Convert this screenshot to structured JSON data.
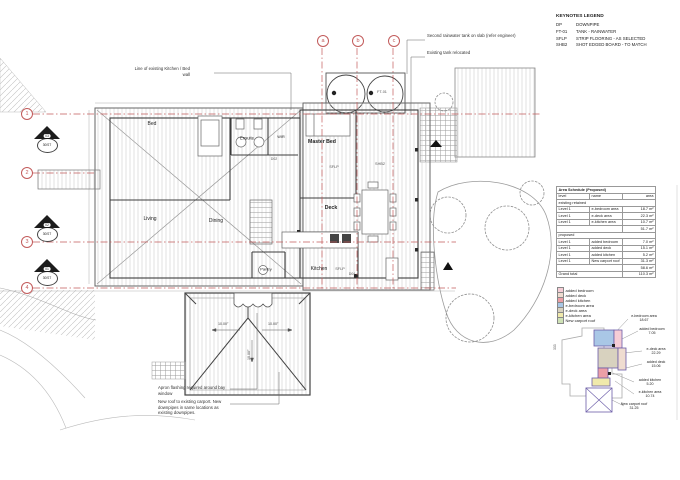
{
  "keynotes": {
    "title": "KEYNOTES LEGEND",
    "items": [
      {
        "code": "DP",
        "desc": "DOWNPIPE"
      },
      {
        "code": "FT-01",
        "desc": "TANK - RAINWATER"
      },
      {
        "code": "SFLP",
        "desc": "STRIP FLOORING - AS SELECTED"
      },
      {
        "code": "SHB2",
        "desc": "SHOT EDGED BOARD - TO MATCH"
      }
    ]
  },
  "area_schedule": {
    "title": "Area Schedule (Proposed)",
    "columns": {
      "level": "level",
      "name": "name",
      "area": "area"
    },
    "section1": "existing retained",
    "rows1": [
      {
        "level": "Level 1",
        "name": "e-bedroom area",
        "area": "18.7 m²"
      },
      {
        "level": "Level 1",
        "name": "e-deck area",
        "area": "22.3 m²"
      },
      {
        "level": "Level 1",
        "name": "e-kitchen area",
        "area": "10.7 m²"
      }
    ],
    "subtotal1": "51.7 m²",
    "section2": "proposed",
    "rows2": [
      {
        "level": "Level 1",
        "name": "added bedroom",
        "area": "7.0 m²"
      },
      {
        "level": "Level 1",
        "name": "added deck",
        "area": "15.1 m²"
      },
      {
        "level": "Level 1",
        "name": "added kitchen",
        "area": "5.2 m²"
      },
      {
        "level": "Level 1",
        "name": "New carport roof",
        "area": "31.3 m²"
      }
    ],
    "subtotal2": "58.6 m²",
    "grand_total_label": "Grand total",
    "grand_total": "110.3 m²"
  },
  "colors": {
    "grid_red": "#c25b5b",
    "added_bedroom": "#f5cdd6",
    "added_deck": "#efdcd0",
    "added_kitchen": "#ec9fa6",
    "e_bedroom": "#a9c7e6",
    "e_deck": "#d8d2bf",
    "e_kitchen": "#f0e9ab",
    "new_carport": "#cfe2b6"
  },
  "color_legend": [
    {
      "label": "added bedroom"
    },
    {
      "label": "added deck"
    },
    {
      "label": "added kitchen"
    },
    {
      "label": "e-bedroom area"
    },
    {
      "label": "e-deck area"
    },
    {
      "label": "e-kitchen area"
    },
    {
      "label": "New carport roof"
    }
  ],
  "key_plan": {
    "labels": [
      {
        "name": "e-bedroom area",
        "value": "18.67"
      },
      {
        "name": "added bedroom",
        "value": "7.05"
      },
      {
        "name": "e-deck area",
        "value": "22.29"
      },
      {
        "name": "added deck",
        "value": "15.06"
      },
      {
        "name": "added kitchen",
        "value": "5.20"
      },
      {
        "name": "e-kitchen area",
        "value": "10.74"
      },
      {
        "name": "New carport roof",
        "value": "31.25"
      }
    ],
    "dim": "333"
  },
  "plan": {
    "rooms": {
      "bed": "Bed",
      "ensuite": "Ensuite",
      "wir": "WIR",
      "master_bed": "Master Bed",
      "living": "Living",
      "dining": "Dining",
      "deck": "Deck",
      "kitchen": "Kitchen",
      "pantry": "Pantry"
    },
    "tags": {
      "ft01": "FT-01",
      "sflp1": "SFLP",
      "shb2": "SHB2",
      "sflp2": "SFLP",
      "d02": "D02",
      "d04": "D04"
    },
    "grid_top": [
      "a",
      "b",
      "c"
    ],
    "grid_left": [
      "1",
      "2",
      "3",
      "4"
    ],
    "sections": [
      {
        "num": "03",
        "ref": "30/ST"
      },
      {
        "num": "02",
        "ref": "30/ST"
      },
      {
        "num": "01",
        "ref": "30/ST"
      }
    ],
    "annotations": {
      "wall_note": "Line of existing Kitchen / Bed wall",
      "tank_note1": "Second rainwater tank on slab (refer engineer)",
      "tank_note2": "Existing tank relocated",
      "apron_note": "Apron flashing required around bay window",
      "carport_note": "New roof to existing carport. New downpipes in same locations as existing downpipes.",
      "slope1": "10.00°",
      "slope2": "10.00°",
      "slope3": "10.00°"
    }
  }
}
